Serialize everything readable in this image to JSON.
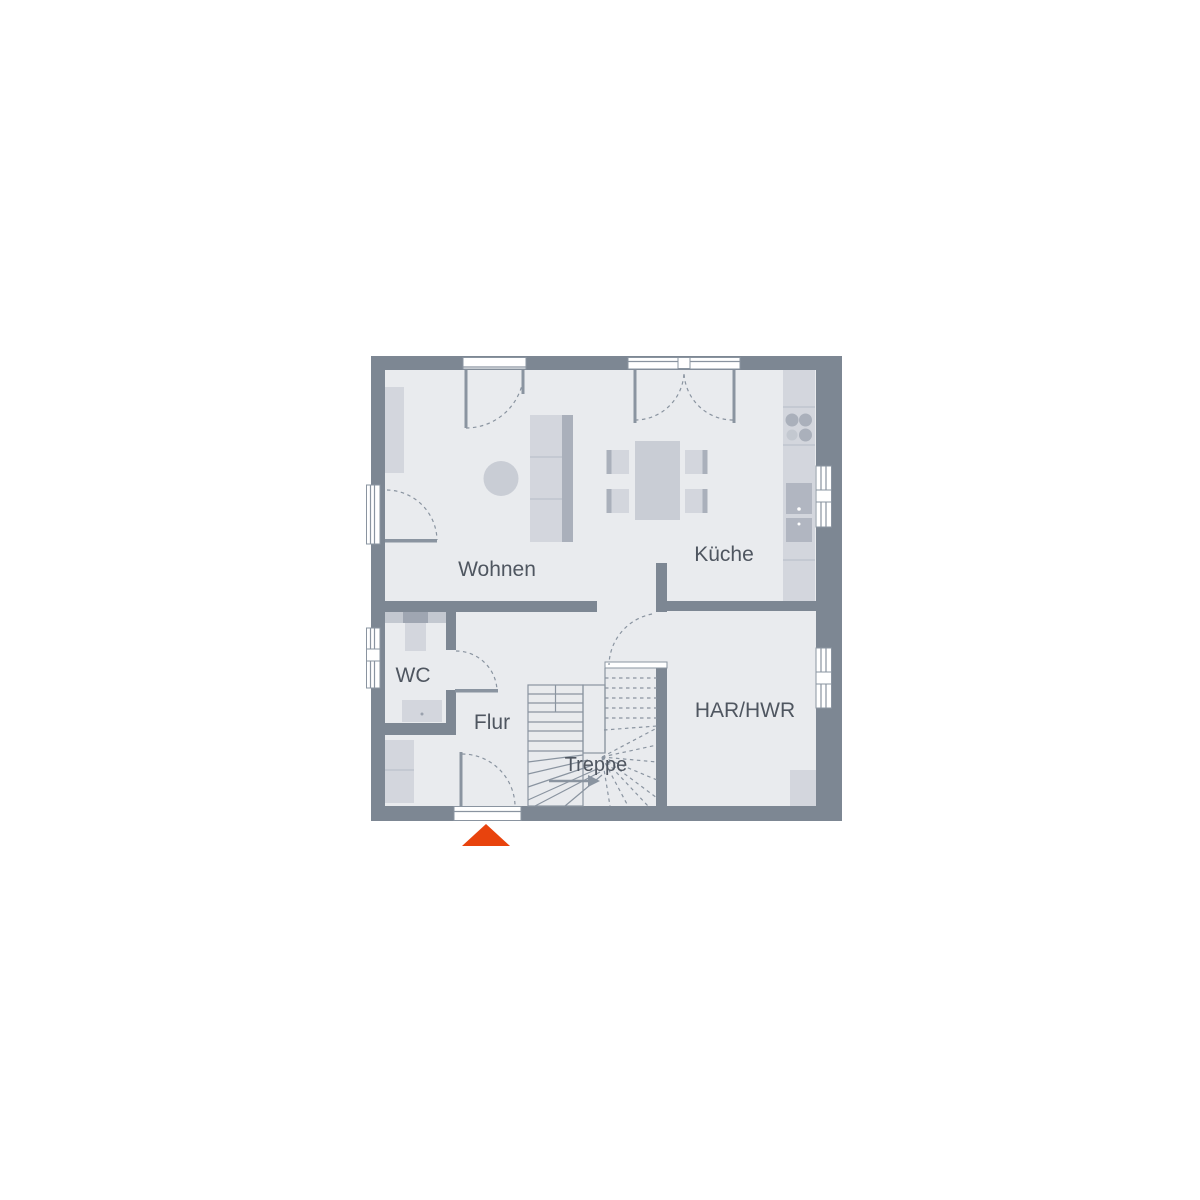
{
  "plan": {
    "type": "floor-plan",
    "rooms": [
      {
        "label": "Wohnen"
      },
      {
        "label": "Küche"
      },
      {
        "label": "WC"
      },
      {
        "label": "Flur"
      },
      {
        "label": "Treppe"
      },
      {
        "label": "HAR/HWR"
      }
    ],
    "colors": {
      "background": "#ffffff",
      "wall": "#7d8793",
      "floor": "#e9ebee",
      "furniture_light": "#d3d6dd",
      "furniture_mid": "#c9cdd5",
      "furniture_dark": "#aab0bb",
      "fixture": "#b1b6c1",
      "line": "#8a94a0",
      "label_text": "#4f5660",
      "entrance_accent": "#e8430d"
    },
    "entrance_marker": {
      "shape": "triangle-up",
      "color": "#e8430d"
    }
  }
}
